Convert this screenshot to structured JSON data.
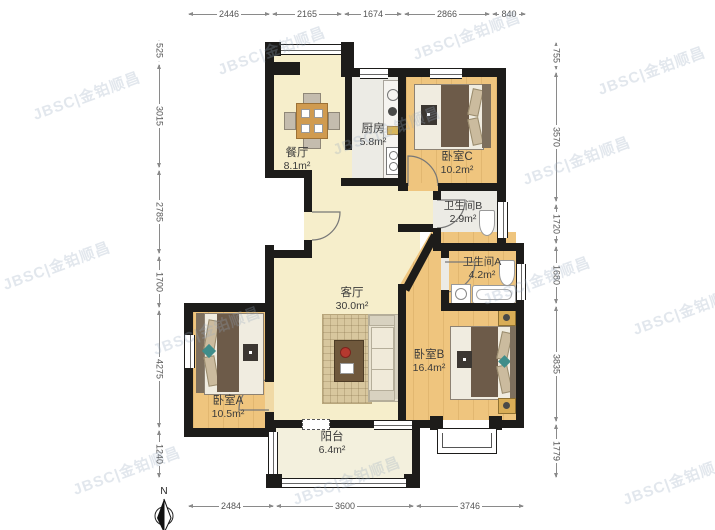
{
  "watermark": {
    "text": "JBSC|金铂顺昌"
  },
  "compass": {
    "label": "N"
  },
  "rooms": {
    "dining": {
      "name": "餐厅",
      "area": "8.1m²"
    },
    "kitchen": {
      "name": "厨房",
      "area": "5.8m²"
    },
    "bedroom_c": {
      "name": "卧室C",
      "area": "10.2m²"
    },
    "bath_b": {
      "name": "卫生间B",
      "area": "2.9m²"
    },
    "bath_a": {
      "name": "卫生间A",
      "area": "4.2m²"
    },
    "living": {
      "name": "客厅",
      "area": "30.0m²"
    },
    "bedroom_b": {
      "name": "卧室B",
      "area": "16.4m²"
    },
    "bedroom_a": {
      "name": "卧室A",
      "area": "10.5m²"
    },
    "balcony": {
      "name": "阳台",
      "area": "6.4m²"
    }
  },
  "dimensions": {
    "top": [
      {
        "value": "2446"
      },
      {
        "value": "2165"
      },
      {
        "value": "1674"
      },
      {
        "value": "2866"
      },
      {
        "value": "840"
      }
    ],
    "left": [
      {
        "value": "525"
      },
      {
        "value": "3015"
      },
      {
        "value": "2785"
      },
      {
        "value": "1700"
      },
      {
        "value": "4275"
      },
      {
        "value": "1240"
      }
    ],
    "right": [
      {
        "value": "755"
      },
      {
        "value": "3570"
      },
      {
        "value": "1720"
      },
      {
        "value": "1680"
      },
      {
        "value": "3835"
      },
      {
        "value": "1779"
      }
    ],
    "bottom": [
      {
        "value": "2484"
      },
      {
        "value": "3600"
      },
      {
        "value": "3746"
      }
    ]
  },
  "colors": {
    "wall": "#1d1c1a",
    "floor_cream": "#f6eecb",
    "floor_wood": "#efc57e",
    "floor_tile": "#ecebe5",
    "floor_balcony": "#f3f0dd"
  }
}
